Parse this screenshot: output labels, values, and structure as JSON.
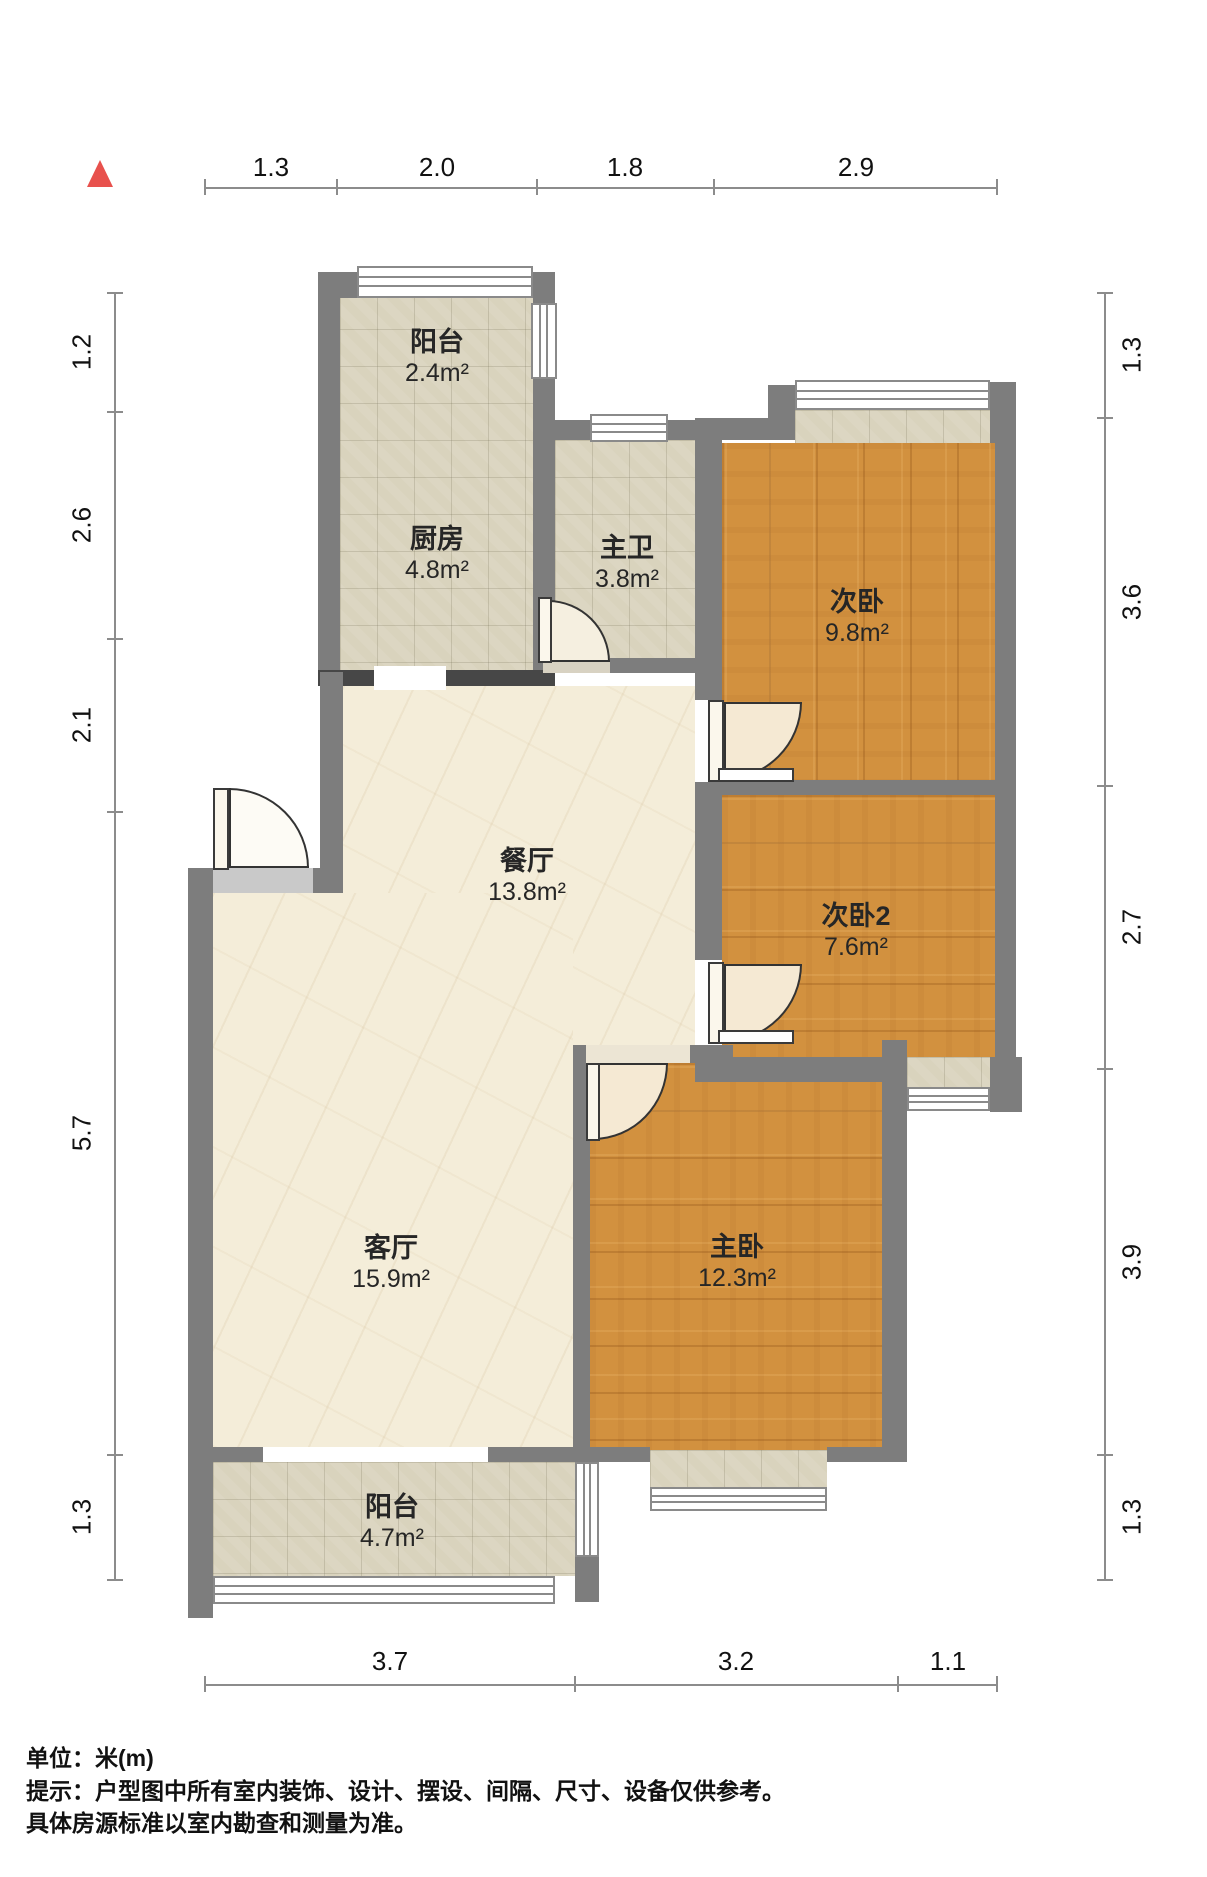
{
  "plan_title": "户型图",
  "north_arrow": "north-indicator",
  "rooms": [
    {
      "name": "阳台",
      "area": "2.4m²"
    },
    {
      "name": "厨房",
      "area": "4.8m²"
    },
    {
      "name": "主卫",
      "area": "3.8m²"
    },
    {
      "name": "次卧",
      "area": "9.8m²"
    },
    {
      "name": "餐厅",
      "area": "13.8m²"
    },
    {
      "name": "次卧2",
      "area": "7.6m²"
    },
    {
      "name": "客厅",
      "area": "15.9m²"
    },
    {
      "name": "主卧",
      "area": "12.3m²"
    },
    {
      "name": "阳台",
      "area": "4.7m²"
    }
  ],
  "dimensions": {
    "top": [
      "1.3",
      "2.0",
      "1.8",
      "2.9"
    ],
    "bottom": [
      "3.7",
      "3.2",
      "1.1"
    ],
    "left": [
      "1.2",
      "2.6",
      "2.1",
      "5.7",
      "1.3"
    ],
    "right": [
      "1.3",
      "3.6",
      "2.7",
      "3.9",
      "1.3"
    ]
  },
  "footer": {
    "line1": "单位：米(m)",
    "line2": "提示：户型图中所有室内装饰、设计、摆设、间隔、尺寸、设备仅供参考。",
    "line3": "具体房源标准以室内勘查和测量为准。"
  },
  "colors": {
    "wall": "#7d7d7d",
    "wall_dark": "#474747",
    "wood_floor": "#d2913f",
    "tile_floor": "#d9d3bd",
    "marble_floor": "#f4edd9",
    "north_arrow": "#e8514d",
    "dimension_line": "#8c8c8c"
  }
}
